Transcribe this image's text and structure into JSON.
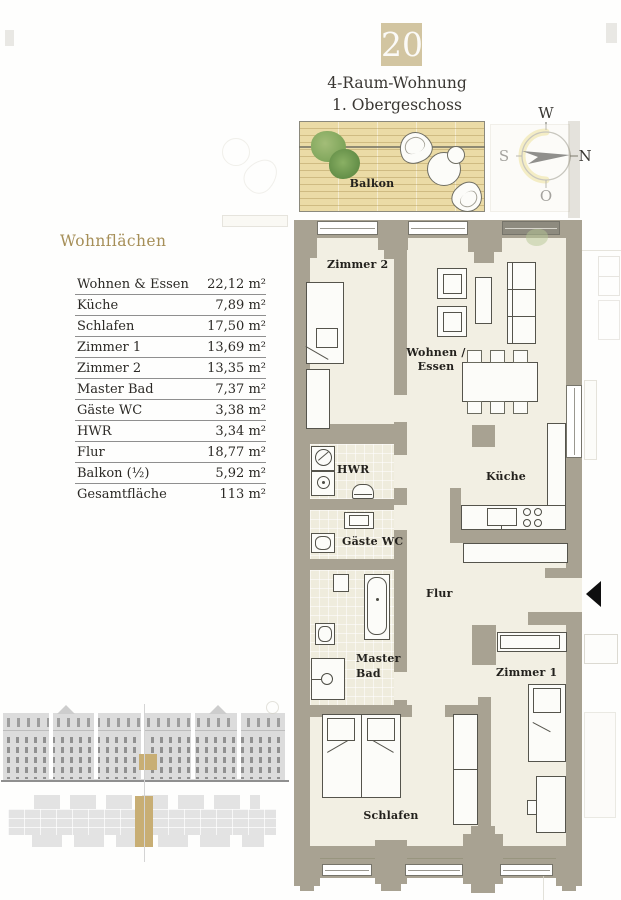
{
  "header": {
    "unit_number": "20",
    "title": "4-Raum-Wohnung",
    "subtitle": "1. Obergeschoss"
  },
  "compass": {
    "west": "W",
    "south": "S",
    "north": "N",
    "east": "O"
  },
  "area_table": {
    "heading": "Wohnflächen",
    "rows": [
      {
        "label": "Wohnen & Essen",
        "value": "22,12 m²"
      },
      {
        "label": "Küche",
        "value": "7,89 m²"
      },
      {
        "label": "Schlafen",
        "value": "17,50 m²"
      },
      {
        "label": "Zimmer 1",
        "value": "13,69 m²"
      },
      {
        "label": "Zimmer 2",
        "value": "13,35 m²"
      },
      {
        "label": "Master Bad",
        "value": "7,37 m²"
      },
      {
        "label": "Gäste WC",
        "value": "3,38 m²"
      },
      {
        "label": "HWR",
        "value": "3,34 m²"
      },
      {
        "label": "Flur",
        "value": "18,77 m²"
      },
      {
        "label": "Balkon (½)",
        "value": "5,92 m²"
      },
      {
        "label": "Gesamtfläche",
        "value": "113 m²"
      }
    ]
  },
  "floorplan": {
    "labels": {
      "balkon": "Balkon",
      "zimmer2": "Zimmer 2",
      "wohnen_essen_1": "Wohnen /",
      "wohnen_essen_2": "Essen",
      "kueche": "Küche",
      "hwr": "HWR",
      "gaeste_wc": "Gäste WC",
      "flur": "Flur",
      "master_bad_1": "Master",
      "master_bad_2": "Bad",
      "schlafen": "Schlafen",
      "zimmer1": "Zimmer 1"
    }
  },
  "colors": {
    "accent_tan": "#d2c5a1",
    "wall_taupe": "#a8a292",
    "floor_cream": "#f2efe3",
    "deck_wood": "#ebdba6",
    "heading_gold": "#a68f58",
    "locator_tan": "#c8ae74"
  }
}
